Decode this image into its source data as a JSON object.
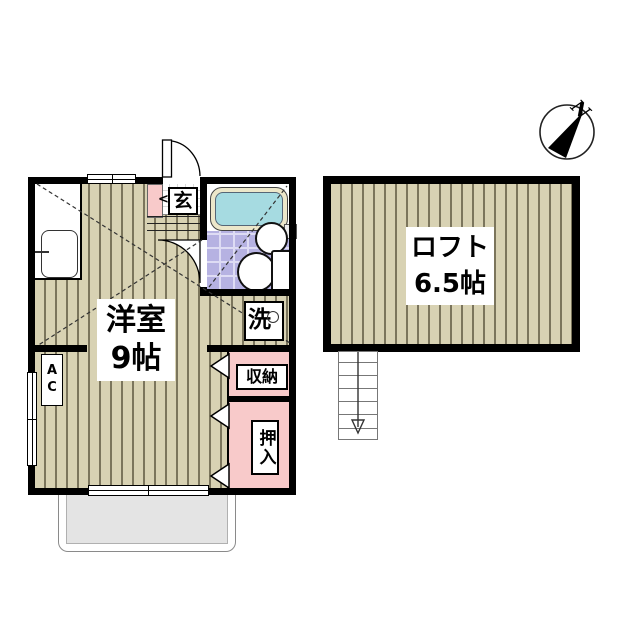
{
  "labels": {
    "room_name": "洋室",
    "room_size": "9帖",
    "loft_name": "ロフト",
    "loft_size": "6.5帖",
    "entrance": "玄",
    "entrance_arrow": "<",
    "washer": "洗",
    "ac_unit": "AC",
    "storage": "収納",
    "futon_closet": "押入",
    "compass_north": "N"
  },
  "colors": {
    "wall": "#000000",
    "flooring": "#d8d2b3",
    "flooring_stripe": "#7b755c",
    "pink_area": "#f8caca",
    "bath_tile": "#b6b2e2",
    "bath_tile_line": "#dedcf4",
    "tub_rim": "#ece7ca",
    "tub_water": "#a6dbe1",
    "balcony_floor": "#e4e4e4",
    "label_bg": "#ffffff"
  }
}
